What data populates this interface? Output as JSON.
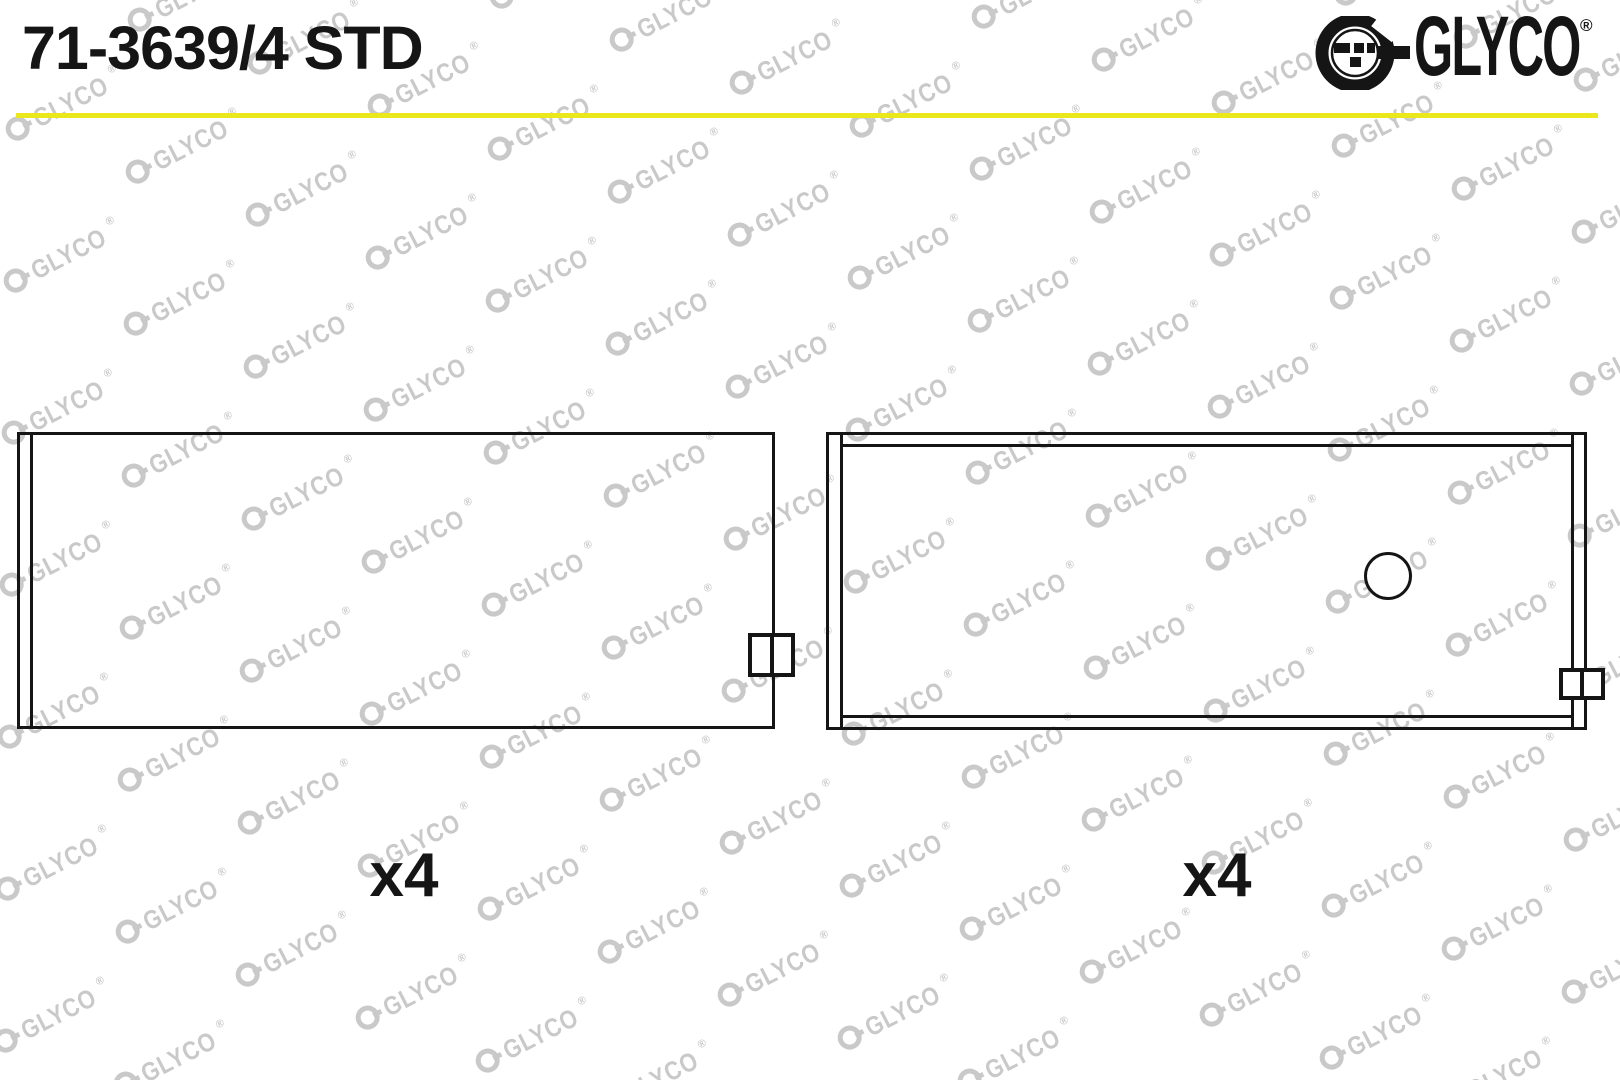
{
  "header": {
    "part_number": "71-3639/4 STD",
    "divider_color": "#ebe71d",
    "brand": {
      "icon": "glyco-ring-icon",
      "name": "GLYCO",
      "registered_mark": "®"
    }
  },
  "watermark": {
    "icon": "glyco-ring-icon",
    "text": "GLYCO",
    "registered_mark": "®",
    "color": "#c9c9c9"
  },
  "figures": {
    "left_shell": {
      "quantity_label": "x4"
    },
    "right_shell": {
      "quantity_label": "x4"
    }
  },
  "colors": {
    "line": "#151515",
    "background": "#ffffff"
  }
}
